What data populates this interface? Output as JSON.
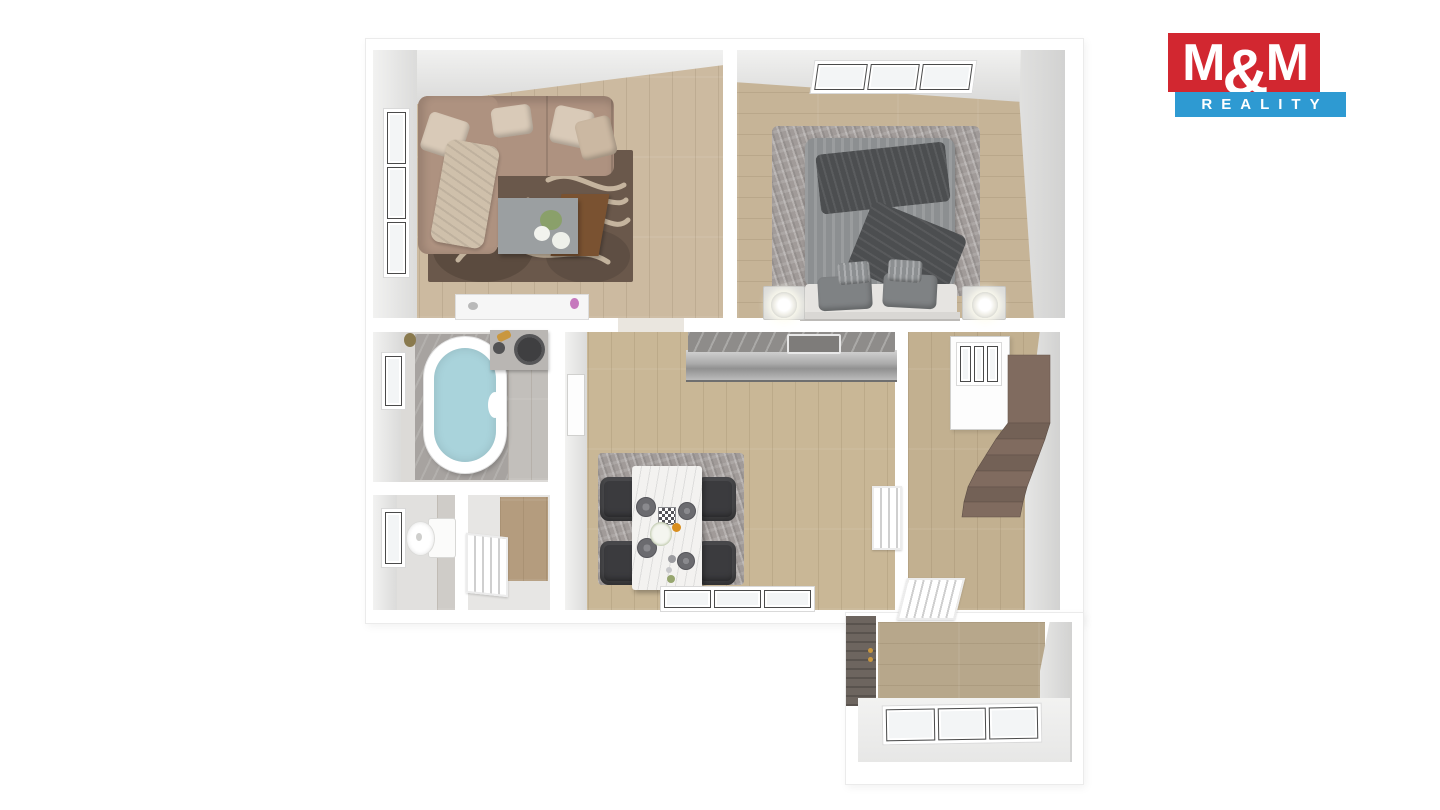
{
  "logo": {
    "m_left": "M",
    "ampersand": "&",
    "m_right": "M",
    "reality": "REALITY"
  },
  "colors": {
    "logo-red": "#d22730",
    "logo-blue": "#2e9ad2",
    "wall-line": "#ebebeb",
    "floor-living": "#ccbaa0",
    "floor-bedroom": "#c6b497",
    "floor-kitchen": "#c9b796",
    "floor-stairhall": "#c2b090",
    "floor-ext": "#b7a78b",
    "floor-bath": "#dcdad7",
    "tile-marble": "#a7a3a0",
    "tile-gray": "#c2bfbb",
    "sofa": "#ae9280",
    "pillow": "#d9cab8",
    "throw": "#cfc0ab",
    "rug-living": "#6a584b",
    "rug-pattern": "#d5c5ad",
    "rug-dark": "#4e4136",
    "rug-gray": "#a19b99",
    "duvet": "#8c8f91",
    "blanket-dark": "#4c4e50",
    "mattress": "#e6e4e1",
    "water": "#a9d3db",
    "counter-marble": "#8e8c8a",
    "table-marble": "#f3f2f0",
    "chair": "#3b3b3e",
    "stairs": "#806b5f",
    "stairs-dark": "#736156",
    "door-wood": "#b49c7e",
    "door-dark": "#6d655f",
    "brass": "#c9973f",
    "plant-green": "#8aa06a",
    "flower-pink": "#c679bd",
    "fruit-orange": "#d98f1f"
  }
}
